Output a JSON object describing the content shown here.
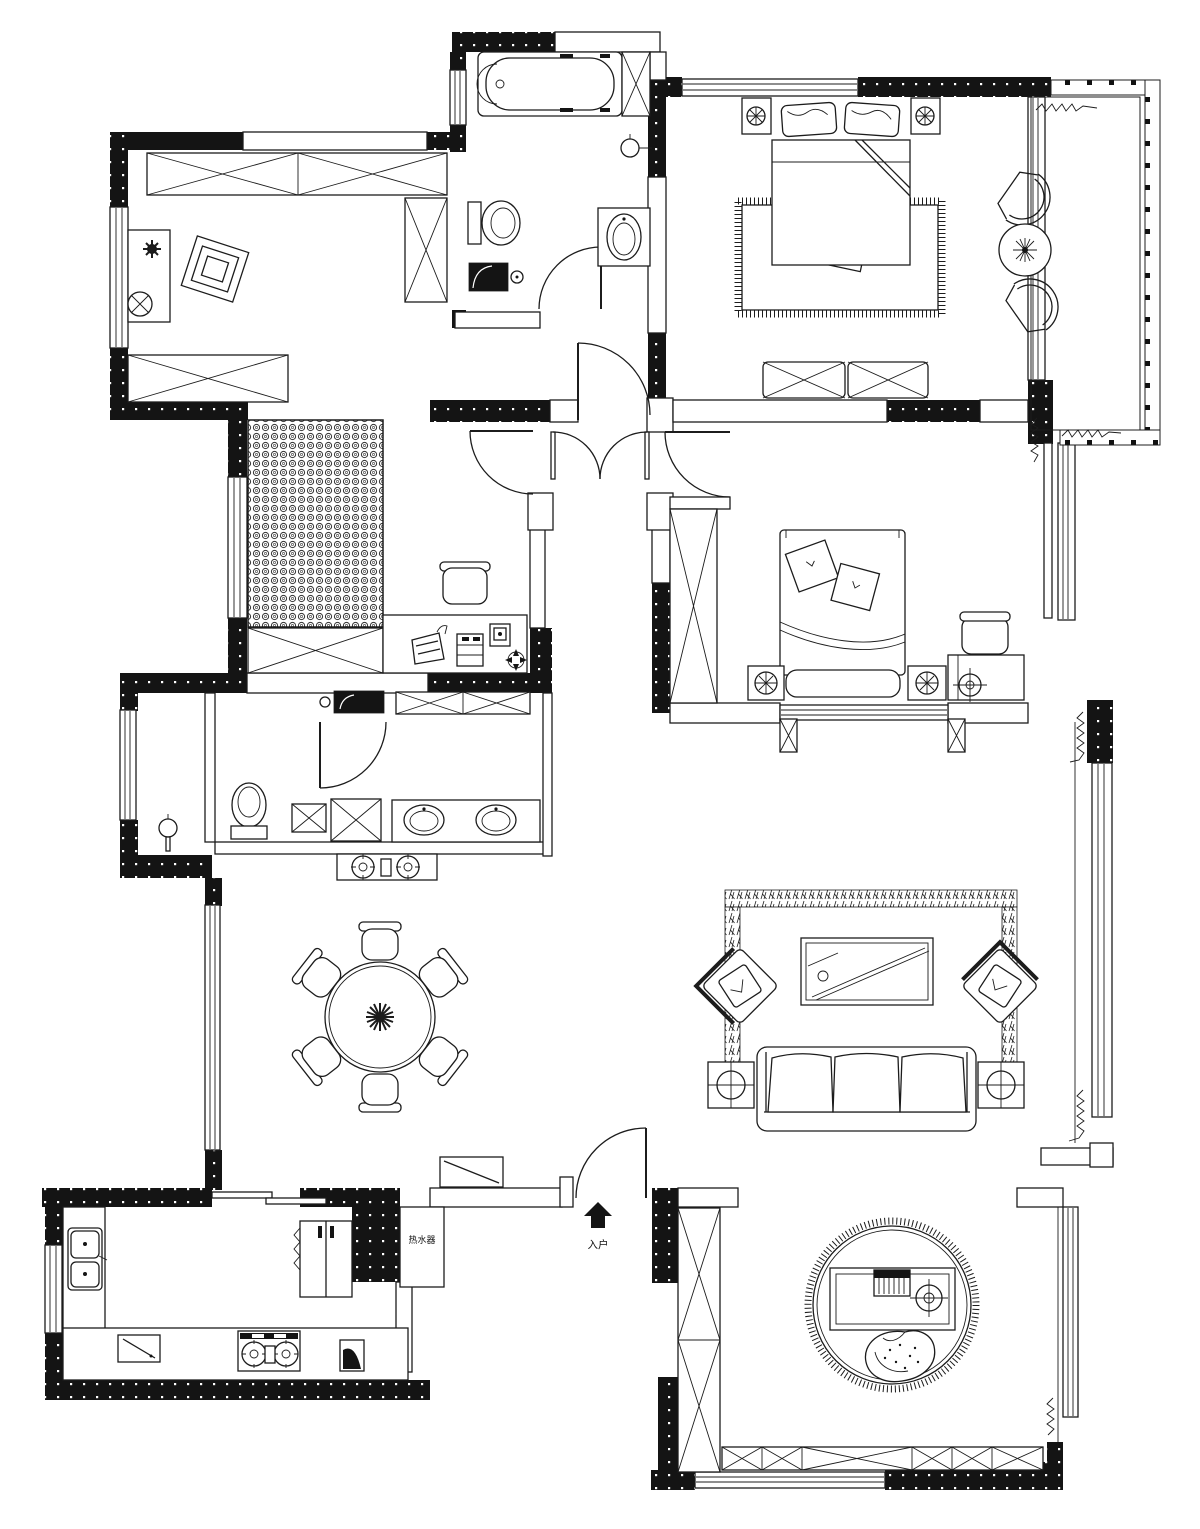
{
  "colors": {
    "ink": "#1c1c1c",
    "wall": "#141414",
    "background": "#ffffff"
  },
  "labels": {
    "entry": "入户",
    "appliance_note": "热水器"
  },
  "plan": {
    "type": "apartment-floor-plan",
    "style": "black-and-white CAD drawing, top view, furnished",
    "rooms": [
      {
        "id": "cloakroom-study",
        "position": "top-left",
        "furniture": [
          "wardrobe-run",
          "side-wardrobe",
          "desk",
          "plant",
          "chair-on-mat",
          "stool",
          "low-wardrobe"
        ]
      },
      {
        "id": "main-bathroom",
        "position": "top-middle",
        "furniture": [
          "bathtub",
          "toilet",
          "washer",
          "pedestal-sink",
          "wall-lamp"
        ]
      },
      {
        "id": "master-bedroom",
        "position": "top-right",
        "furniture": [
          "double-bed",
          "two-pillows",
          "two-nightstands-with-lamps",
          "fringed-rug",
          "cushions",
          "two-low-cabinets"
        ]
      },
      {
        "id": "balcony",
        "position": "top-right-edge",
        "furniture": [
          "fan-chair",
          "fan-chair",
          "round-plant-table"
        ],
        "features": [
          "post-railing",
          "curtains"
        ]
      },
      {
        "id": "tatami-study",
        "position": "middle-left",
        "furniture": [
          "woven-tatami-bed",
          "cabinet",
          "desk",
          "chair",
          "waste-basket",
          "drawer-unit",
          "compass-symbol"
        ]
      },
      {
        "id": "second-bedroom",
        "position": "middle-right",
        "furniture": [
          "bed",
          "two-diamond-pillows",
          "two-nightstands",
          "tall-wardrobe",
          "desk",
          "chair",
          "bay-window"
        ]
      },
      {
        "id": "second-bathroom",
        "position": "middle-left-lower",
        "furniture": [
          "toilet",
          "shower-floor-tiles",
          "double-sink-vanity"
        ]
      },
      {
        "id": "laundry-balcony",
        "position": "left",
        "furniture": [
          "wall-faucet"
        ]
      },
      {
        "id": "dining-room",
        "position": "center-left",
        "furniture": [
          "round-table",
          "six-chairs",
          "centerpiece-plant",
          "sideboard",
          "wall-tv",
          "two-burner-cabinet"
        ]
      },
      {
        "id": "living-room",
        "position": "center-right",
        "furniture": [
          "three-seat-sofa",
          "glass-coffee-table",
          "armchair",
          "armchair",
          "two-lamp-side-tables",
          "area-rug"
        ]
      },
      {
        "id": "kitchen",
        "position": "bottom-left",
        "furniture": [
          "l-shaped-counter",
          "double-sink",
          "cutting-board",
          "two-burner-gas-stove",
          "corner-unit",
          "refrigerator",
          "sliding-door"
        ]
      },
      {
        "id": "entry",
        "position": "bottom-center",
        "furniture": [
          "shoe-cabinet",
          "entry-arrow",
          "water-heater-nook"
        ]
      },
      {
        "id": "piano-room",
        "position": "bottom-right",
        "furniture": [
          "keyboard-desk",
          "round-stool",
          "lounge-chair",
          "round-fringed-rug",
          "tall-wardrobe",
          "low-cabinet-run"
        ]
      }
    ]
  }
}
